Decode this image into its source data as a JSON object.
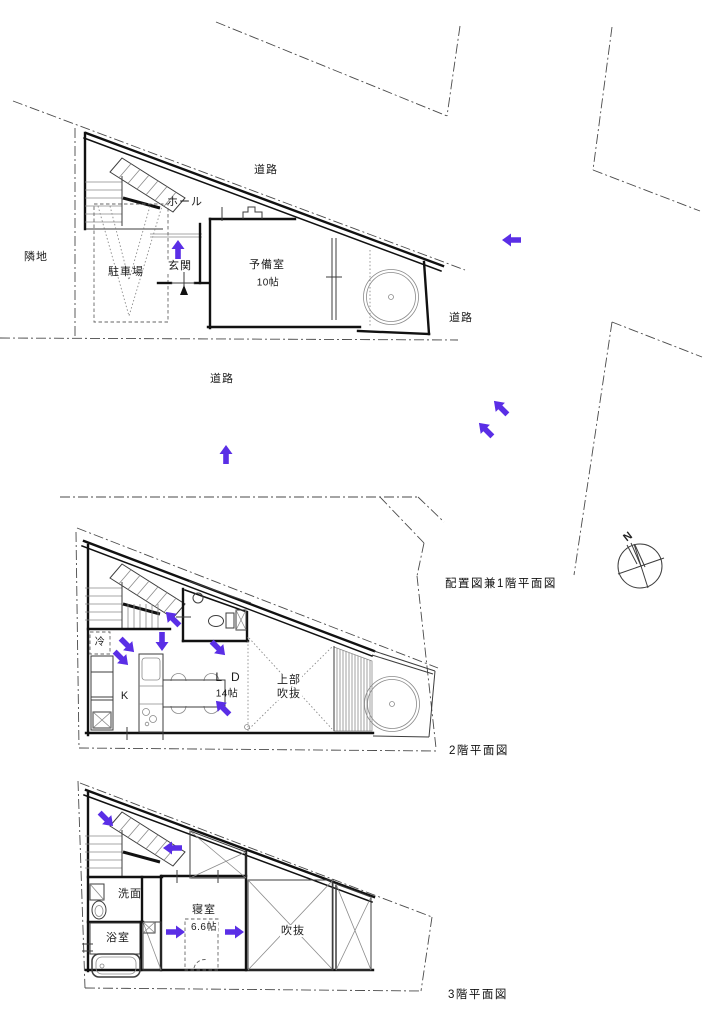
{
  "colors": {
    "flow_arrow": "#5a2ee6",
    "walls": "#111111",
    "site_boundary": "#4a4a4a",
    "detail_lines": "#8a8a8a"
  },
  "site": {
    "road_label_top": "道路",
    "road_label_right": "道路",
    "road_label_bottom": "道路",
    "adjacent_lot_label": "隣地",
    "compass_north": "N"
  },
  "floor1": {
    "caption": "配置図兼1階平面図",
    "hall": "ホール",
    "parking": "駐車場",
    "entrance": "玄関",
    "spare_room": "予備室",
    "spare_room_size": "10帖"
  },
  "floor2": {
    "caption": "2階平面図",
    "refrigerator": "冷",
    "kitchen": "K",
    "living_dining": "L D",
    "living_dining_size": "14帖",
    "void_above_line1": "上部",
    "void_above_line2": "吹抜"
  },
  "floor3": {
    "caption": "3階平面図",
    "washroom": "洗面",
    "bathroom": "浴室",
    "bedroom": "寝室",
    "bedroom_size": "6.6帖",
    "void": "吹抜"
  },
  "flow_arrows": [
    {
      "x": 178,
      "y": 250,
      "deg": -90,
      "dir": "up"
    },
    {
      "x": 512,
      "y": 240,
      "deg": 180,
      "dir": "left"
    },
    {
      "x": 226,
      "y": 455,
      "deg": -90,
      "dir": "up"
    },
    {
      "x": 486,
      "y": 430,
      "deg": -135,
      "dir": "up-left"
    },
    {
      "x": 501,
      "y": 408,
      "deg": -135,
      "dir": "up-left"
    },
    {
      "x": 173,
      "y": 619,
      "deg": -135,
      "dir": "up-left"
    },
    {
      "x": 127,
      "y": 645,
      "deg": 45,
      "dir": "down-right"
    },
    {
      "x": 121,
      "y": 658,
      "deg": 45,
      "dir": "down-right"
    },
    {
      "x": 162,
      "y": 641,
      "deg": 90,
      "dir": "down"
    },
    {
      "x": 218,
      "y": 648,
      "deg": 45,
      "dir": "down-right"
    },
    {
      "x": 223,
      "y": 708,
      "deg": -135,
      "dir": "up-left"
    },
    {
      "x": 106,
      "y": 819,
      "deg": 45,
      "dir": "down-right"
    },
    {
      "x": 173,
      "y": 848,
      "deg": 180,
      "dir": "left"
    },
    {
      "x": 175,
      "y": 932,
      "deg": 0,
      "dir": "right"
    },
    {
      "x": 234,
      "y": 932,
      "deg": 0,
      "dir": "right"
    }
  ]
}
